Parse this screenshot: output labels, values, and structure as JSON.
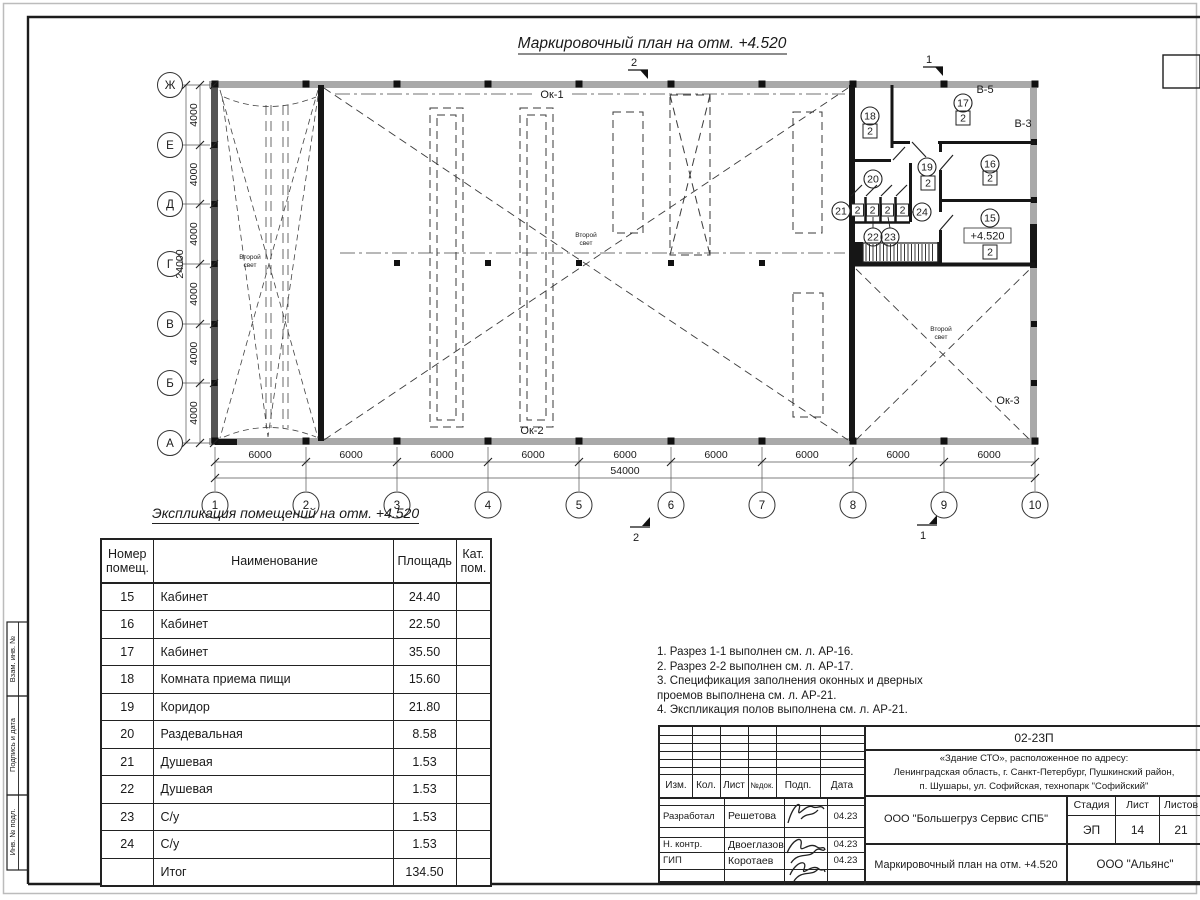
{
  "sheet": {
    "plan_title": "Маркировочный план на отм. +4.520",
    "table_title": "Экспликация помещений на отм. +4.520"
  },
  "plan": {
    "axes_letters": [
      "Ж",
      "Е",
      "Д",
      "Г",
      "В",
      "Б",
      "А"
    ],
    "axes_numbers": [
      "1",
      "2",
      "3",
      "4",
      "5",
      "6",
      "7",
      "8",
      "9",
      "10"
    ],
    "dim_bottom_segments": [
      "6000",
      "6000",
      "6000",
      "6000",
      "6000",
      "6000",
      "6000",
      "6000",
      "6000"
    ],
    "dim_bottom_total": "54000",
    "dim_left_segments": [
      "4000",
      "4000",
      "4000",
      "4000",
      "4000",
      "4000"
    ],
    "dim_left_total": "24000",
    "labels": {
      "ok1": "Ок-1",
      "ok2": "Ок-2",
      "ok3": "Ок-3",
      "v5": "В-5",
      "v3": "В-3"
    },
    "second_light": {
      "line1": "Второй",
      "line2": "свет"
    },
    "level_mark": "+4.520",
    "section_marks": {
      "s1": "1",
      "s2": "2"
    },
    "rooms": [
      {
        "num": "15",
        "cat": "2"
      },
      {
        "num": "16",
        "cat": "2"
      },
      {
        "num": "17",
        "cat": "2"
      },
      {
        "num": "18",
        "cat": "2"
      },
      {
        "num": "19",
        "cat": "2"
      },
      {
        "num": "20",
        "cat": ""
      },
      {
        "num": "21",
        "cat": "2"
      },
      {
        "num": "22",
        "cat": "2"
      },
      {
        "num": "23",
        "cat": "2"
      },
      {
        "num": "24",
        "cat": "2"
      }
    ]
  },
  "table": {
    "col_num": "Номер\nпомещ.",
    "col_name": "Наименование",
    "col_area": "Площадь",
    "col_cat": "Кат.\nпом.",
    "rows": [
      {
        "num": "15",
        "name": "Кабинет",
        "area": "24.40"
      },
      {
        "num": "16",
        "name": "Кабинет",
        "area": "22.50"
      },
      {
        "num": "17",
        "name": "Кабинет",
        "area": "35.50"
      },
      {
        "num": "18",
        "name": "Комната приема пищи",
        "area": "15.60"
      },
      {
        "num": "19",
        "name": "Коридор",
        "area": "21.80"
      },
      {
        "num": "20",
        "name": "Раздевальная",
        "area": "8.58"
      },
      {
        "num": "21",
        "name": "Душевая",
        "area": "1.53"
      },
      {
        "num": "22",
        "name": "Душевая",
        "area": "1.53"
      },
      {
        "num": "23",
        "name": "С/у",
        "area": "1.53"
      },
      {
        "num": "24",
        "name": "С/у",
        "area": "1.53"
      },
      {
        "num": "",
        "name": "Итог",
        "area": "134.50"
      }
    ]
  },
  "notes": [
    "1. Разрез 1-1 выполнен см. л. АР-16.",
    "2. Разрез 2-2 выполнен см. л. АР-17.",
    "3. Спецификация заполнения оконных и дверных\n    проемов выполнена см. л. АР-21.",
    "4. Экспликация полов выполнена см. л. АР-21."
  ],
  "titleblock": {
    "doc_code": "02-23П",
    "address_lines": [
      "«Здание СТО», расположенное по адресу:",
      "Ленинградская область, г. Санкт-Петербург, Пушкинский район,",
      "п. Шушары, ул. Софийская, технопарк \"Софийский\""
    ],
    "cols": [
      "Изм.",
      "Кол.",
      "Лист",
      "№док.",
      "Подп.",
      "Дата"
    ],
    "roles": [
      {
        "role": "Разработал",
        "name": "Решетова",
        "date": "04.23"
      },
      {
        "role": "Н. контр.",
        "name": "Двоеглазов",
        "date": "04.23"
      },
      {
        "role": "ГИП",
        "name": "Коротаев",
        "date": "04.23"
      }
    ],
    "org": "ООО \"Большегруз Сервис СПБ\"",
    "stage_label": "Стадия",
    "sheet_label": "Лист",
    "sheets_label": "Листов",
    "stage": "ЭП",
    "sheet_num": "14",
    "sheets_total": "21",
    "doc_name": "Маркировочный план на отм. +4.520",
    "org2": "ООО \"Альянс\""
  },
  "side_strip": {
    "labels": [
      "Взам. инв. №",
      "Подпись и дата",
      "Инв. № подл."
    ]
  }
}
